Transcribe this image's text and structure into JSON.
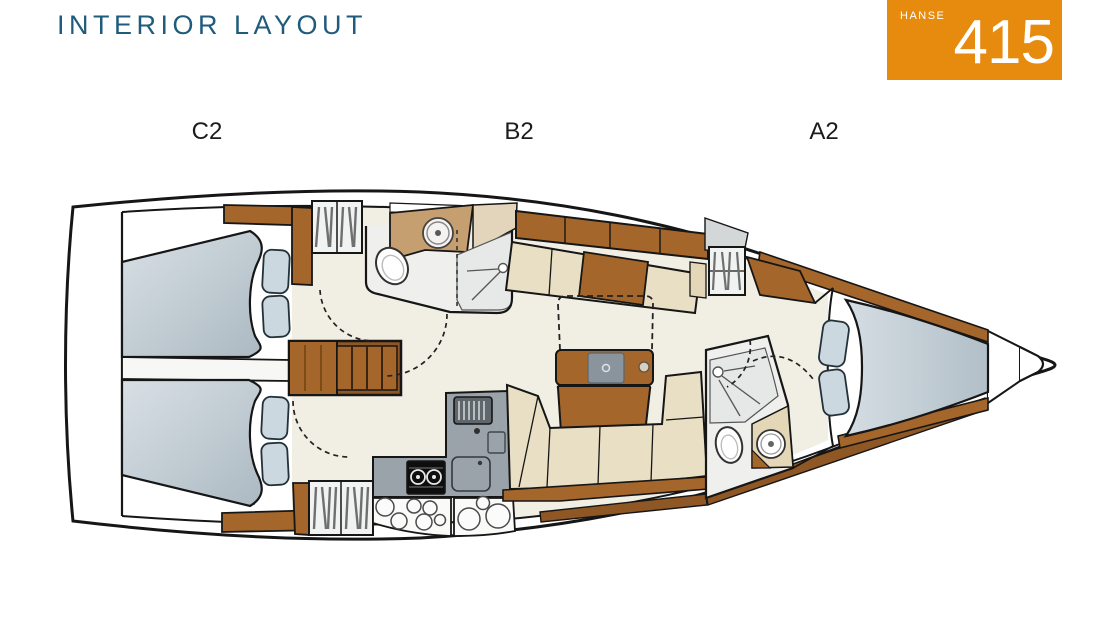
{
  "header": {
    "title": "INTERIOR LAYOUT"
  },
  "badge": {
    "brand": "HANSE",
    "model": "415"
  },
  "plan_labels": [
    {
      "id": "C2",
      "text": "C2"
    },
    {
      "id": "B2",
      "text": "B2"
    },
    {
      "id": "A2",
      "text": "A2"
    }
  ],
  "colors": {
    "accent_orange": "#E78B0F",
    "title_teal": "#1F5B7D",
    "wood_brown": "#A4662A",
    "wood_dark": "#8E5724",
    "cushion_beige": "#E9DFC4",
    "counter_tan": "#C59F6F",
    "mattress_blue": "#C7D3DC",
    "galley_gray": "#9BA3AA",
    "floor_cream": "#F1EEE3",
    "line_black": "#161616"
  },
  "icons": [
    "boat-hull-outline",
    "berth-mattress",
    "pillow-icon",
    "wardrobe-slats-icon",
    "companionway-stairs-icon",
    "toilet-icon",
    "sink-icon",
    "shower-icon",
    "stove-icon",
    "fridge-vent-icon",
    "galley-sink-icon",
    "salon-table",
    "table-extension-dashed",
    "settee-cushions",
    "door-swing-arc",
    "bow-locker"
  ]
}
